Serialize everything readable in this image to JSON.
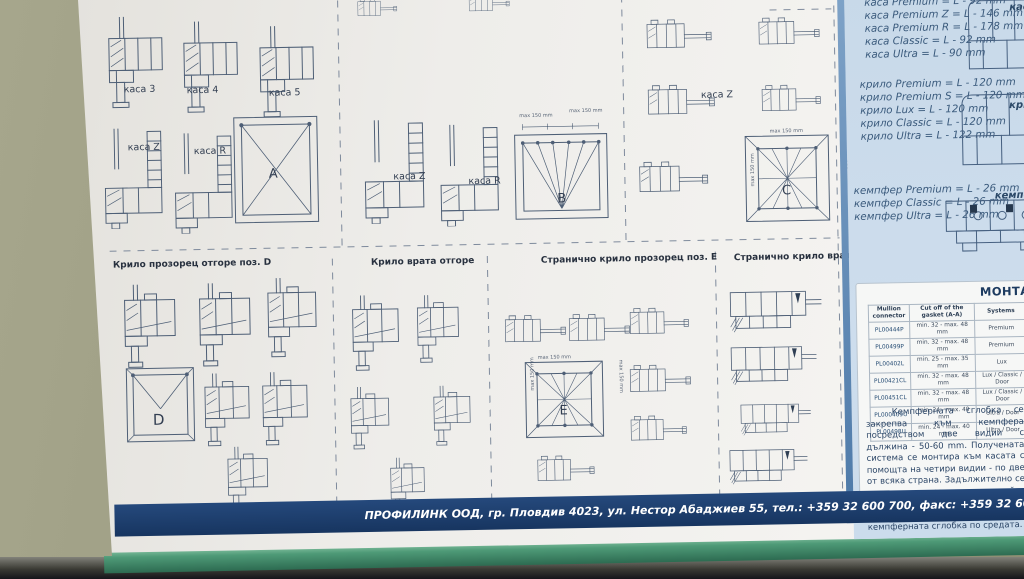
{
  "poster": {
    "heading_c": "Странично на каса поз. C",
    "labels": {
      "kasa3": "каса 3",
      "kasa4": "каса 4",
      "kasa5": "каса 5",
      "kasaZ": "каса Z",
      "kasaR": "каса R",
      "A": "A",
      "B": "B",
      "C": "C",
      "D": "D",
      "E": "E",
      "dim": "max 150 mm"
    },
    "bottom_headings": {
      "krilo_prozorec_d": "Крило прозорец отгоре поз. D",
      "krilo_vrata": "Крило врата отгоре",
      "stranichno_krilo_e": "Странично крило прозорец поз. E",
      "stranichno_krilo_vrata": "Странично крило врата"
    }
  },
  "side_panel": {
    "kasa": {
      "label": "каса",
      "dims": [
        "каса Premium = L - 92 mm",
        "каса Premium Z = L - 146 mm",
        "каса Premium R = L - 178 mm",
        "каса Classic = L - 92 mm",
        "каса Ultra = L - 90 mm"
      ]
    },
    "krilo": {
      "label": "крило",
      "dims": [
        "крило Premium = L - 120 mm",
        "крило Premium S = L - 120 mm",
        "крило Lux = L - 120 mm",
        "крило Classic = L - 120 mm",
        "крило Ultra = L - 122 mm"
      ]
    },
    "kempfer": {
      "label": "кемпфер",
      "dims": [
        "кемпфер Premium = L - 26 mm",
        "кемпфер Classic = L - 26 mm",
        "кемпфер Ultra = L - 26 mm"
      ]
    },
    "montage": {
      "title": "МОНТАЖ НА СТА",
      "table": {
        "columns": [
          "Mullion connector",
          "Cut off of the gasket (A-A)",
          "Systems"
        ],
        "rows": [
          [
            "PL00444P",
            "min. 32 - max. 48 mm",
            "Premium"
          ],
          [
            "PL00499P",
            "min. 32 - max. 48 mm",
            "Premium"
          ],
          [
            "PL00402L",
            "min. 25 - max. 35 mm",
            "Lux"
          ],
          [
            "PL00421CL",
            "min. 32 - max. 48 mm",
            "Lux / Classic / Door"
          ],
          [
            "PL00451CL",
            "min. 32 - max. 48 mm",
            "Lux / Classic / Door"
          ],
          [
            "PL000409U",
            "min. 24 - max. 40 mm",
            "Ultra / Door"
          ],
          [
            "PL00498U",
            "min. 24 - max. 40 mm",
            "Ultra / Door"
          ]
        ]
      },
      "note": "Кемпферната сглобка се закрепва към кемпфера посредством две видии с дължина - 50-60 mm. Получената система се монтира към касата с помощта на четири видии - по две от всяка страна. Задължително се поставя централен винт, който преминава през касата, нейния усилител и се завива в кемпферната сглобка по средата.",
      "cut_label": "A-A"
    }
  },
  "footer": {
    "text": "ПРОФИЛИНК ООД, гр. Пловдив 4023, ул. Нестор Абаджиев 55, тел.: +359 32 600 700, факс: +359 32 600 900, e-mail: office@profilink.eu"
  }
}
